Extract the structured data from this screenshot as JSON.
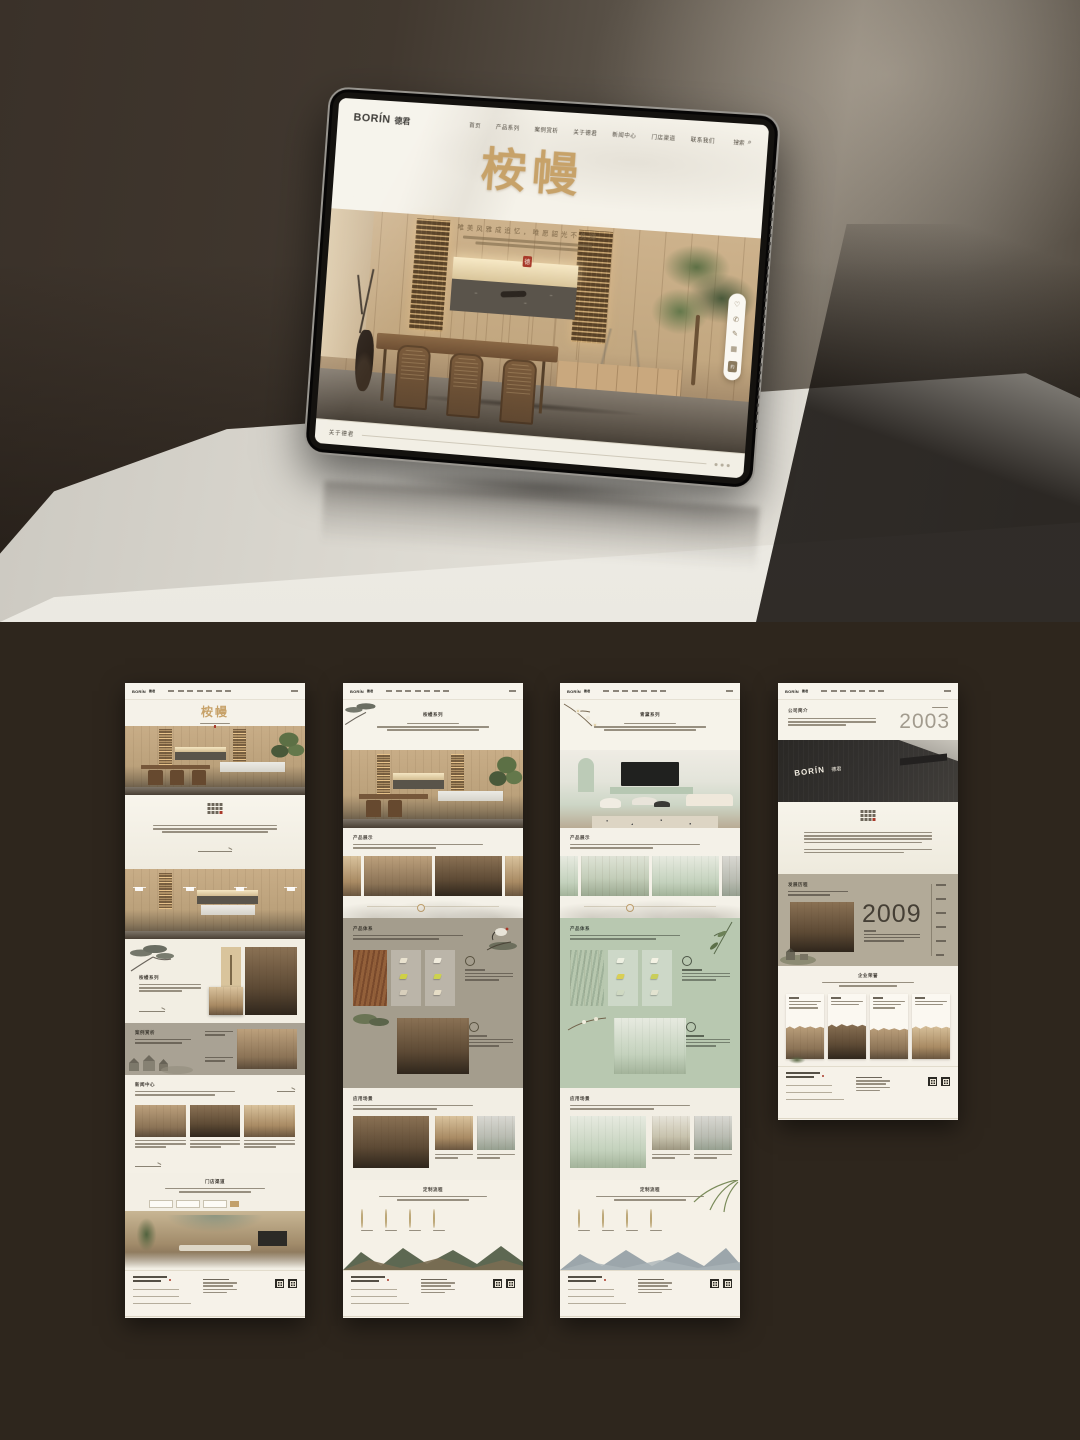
{
  "colors": {
    "accent_gold": "#c2a06b",
    "seal_red": "#a8392a",
    "cream": "#f3efe6",
    "taupe": "#a8a193",
    "mint": "#bdcbb4",
    "dark_brown": "#2e261d"
  },
  "tablet": {
    "logo_en": "BORÍN",
    "logo_cn": "德君",
    "nav": [
      "首页",
      "产品系列",
      "案例赏析",
      "关于德君",
      "新闻中心",
      "门店渠道",
      "联系我们"
    ],
    "search_label": "搜索",
    "search_icon": "magnifier-icon",
    "hero_title": "桉幔",
    "hero_subtitle": "唯美风雅成追忆，唯愿韶光不负卿",
    "seal_char": "德",
    "bottom_link": "关于德君",
    "toolbar_icons": [
      "heart-icon",
      "phone-icon",
      "edit-icon",
      "qr-icon"
    ],
    "toolbar_tag": "约"
  },
  "thumbs": {
    "home": {
      "hero_title": "桉幔",
      "series_title": "桉幔系列",
      "cases_title": "案例赏析",
      "news_title": "新闻中心",
      "stores_title": "门店渠道"
    },
    "wood": {
      "page_title": "桉幔系列",
      "display_title": "产品展示",
      "system_title": "产品体系",
      "scenes_title": "应用场景",
      "process_title": "定制流程"
    },
    "green": {
      "page_title": "青黛系列",
      "display_title": "产品展示",
      "system_title": "产品体系",
      "scenes_title": "应用场景",
      "process_title": "定制流程"
    },
    "about": {
      "intro_title": "公司简介",
      "year_founded": "2003",
      "building_logo_en": "BORÍN",
      "building_logo_cn": "德君",
      "history_title": "发展历程",
      "milestone_year": "2009",
      "honors_title": "企业荣誉"
    }
  }
}
